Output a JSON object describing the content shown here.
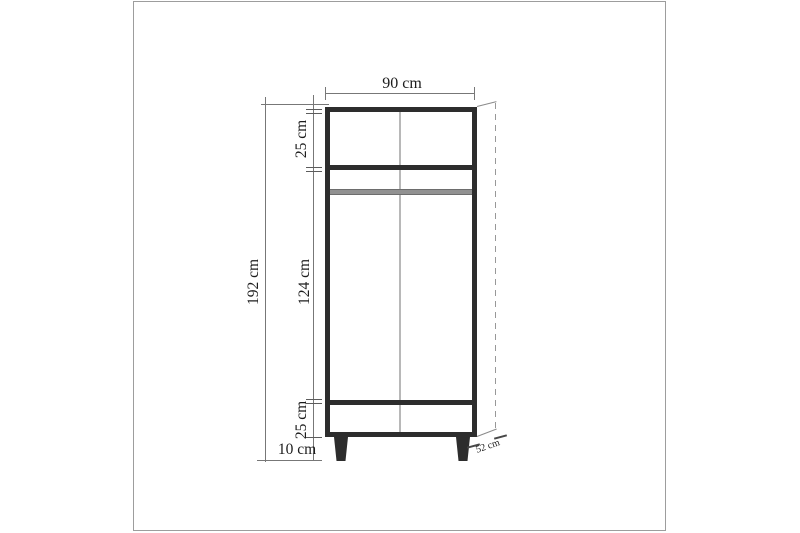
{
  "diagram": {
    "type": "furniture dimension drawing",
    "item": "two-door wardrobe, front elevation with depth projection"
  },
  "dims": {
    "width": "90 cm",
    "top_section": "25 cm",
    "total_height": "192 cm",
    "middle_section": "124 cm",
    "drawer_section": "25 cm",
    "leg_height": "10 cm",
    "depth": "52 cm"
  },
  "colors": {
    "outline": "#2d2d2d",
    "dim_line": "#777777",
    "divider": "#b8b8b8",
    "rod": "#919191",
    "page_border": "#9d9d9d",
    "text": "#1c1c1c"
  }
}
